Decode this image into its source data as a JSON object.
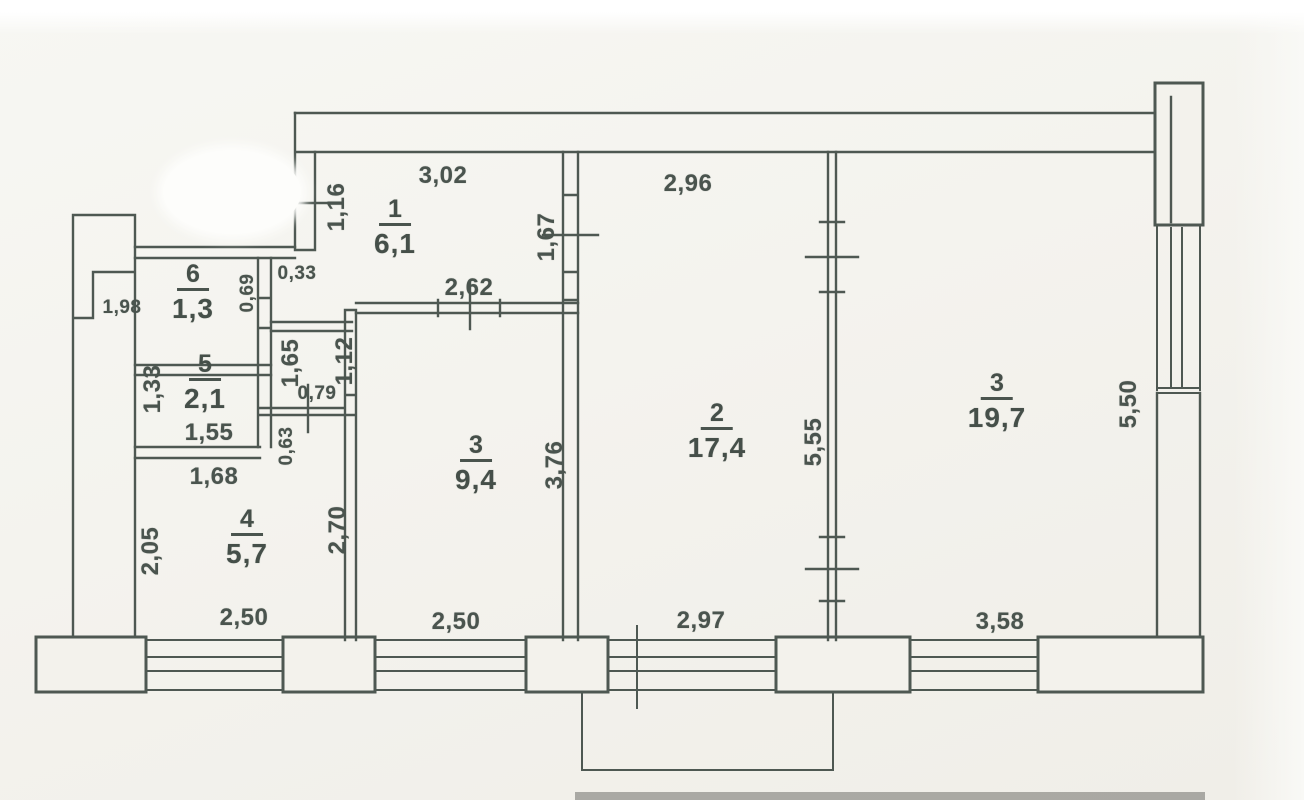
{
  "document": {
    "kind": "apartment floor plan (BTI technical drawing)",
    "units": "meters / square meters",
    "ink_color": "#4a544e",
    "paper_color": "#f4f3ee",
    "redaction": "white correction-fluid oval at top left"
  },
  "rooms": [
    {
      "number": "1",
      "area": "6,1"
    },
    {
      "number": "6",
      "area": "1,3"
    },
    {
      "number": "5",
      "area": "2,1"
    },
    {
      "number": "4",
      "area": "5,7"
    },
    {
      "number": "3",
      "area": "9,4"
    },
    {
      "number": "2",
      "area": "17,4"
    },
    {
      "number": "3",
      "area": "19,7"
    }
  ],
  "dimensions": [
    {
      "id": "hall-top-width",
      "value": "3,02"
    },
    {
      "id": "room2-top-width",
      "value": "2,96"
    },
    {
      "id": "hall-entry-door",
      "value": "1,16"
    },
    {
      "id": "hall-room2-opening",
      "value": "1,67"
    },
    {
      "id": "wall-stub",
      "value": "0,33"
    },
    {
      "id": "wc-door",
      "value": "0,69"
    },
    {
      "id": "left-niche",
      "value": "1,98"
    },
    {
      "id": "room3-door-wall",
      "value": "2,62"
    },
    {
      "id": "corridor-upper",
      "value": "1,12"
    },
    {
      "id": "corridor-side",
      "value": "1,65"
    },
    {
      "id": "bath-width",
      "value": "1,33"
    },
    {
      "id": "corridor-door",
      "value": "0,79"
    },
    {
      "id": "room2-depth",
      "value": "5,55"
    },
    {
      "id": "room19-right-depth",
      "value": "5,50"
    },
    {
      "id": "bath-length",
      "value": "1,55"
    },
    {
      "id": "corridor-lower",
      "value": "0,63"
    },
    {
      "id": "kitchen-top",
      "value": "1,68"
    },
    {
      "id": "room3-depth",
      "value": "3,76"
    },
    {
      "id": "kitchen-right",
      "value": "2,70"
    },
    {
      "id": "kitchen-left",
      "value": "2,05"
    },
    {
      "id": "kitchen-window",
      "value": "2,50"
    },
    {
      "id": "room3-window",
      "value": "2,50"
    },
    {
      "id": "room2-window",
      "value": "2,97"
    },
    {
      "id": "room19-window",
      "value": "3,58"
    }
  ]
}
